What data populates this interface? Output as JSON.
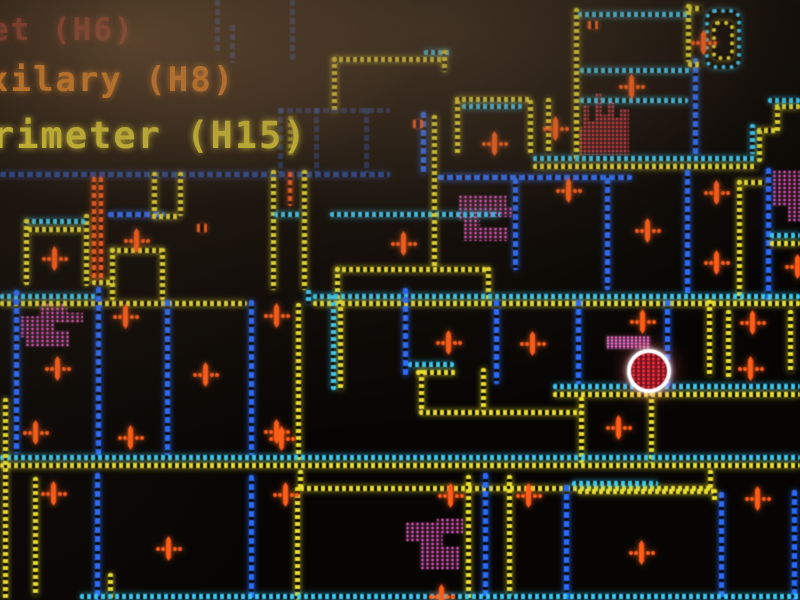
{
  "legend": {
    "items": [
      {
        "label": "et (H6)",
        "color": "#8f2a24"
      },
      {
        "label": "xilary (H8)",
        "color": "#e67d17"
      },
      {
        "label": "rimeter (H15)",
        "color": "#e3da2e"
      }
    ]
  },
  "map": {
    "colors": {
      "yellow": "#e9df3c",
      "cyan": "#41c9f2",
      "blue": "#2f6bf2",
      "orange": "#ff5f1f",
      "magenta": "#d95cb8",
      "red_hatch": "#cf3a4a",
      "pink_label": "#e773c9",
      "alarm_fill": "#70121c",
      "alarm_ring": "#ffffff"
    },
    "markers": [
      [
        703,
        42
      ],
      [
        631,
        86
      ],
      [
        494,
        143
      ],
      [
        555,
        128
      ],
      [
        716,
        192
      ],
      [
        716,
        262
      ],
      [
        797,
        266
      ],
      [
        54,
        258
      ],
      [
        136,
        240
      ],
      [
        403,
        243
      ],
      [
        568,
        190
      ],
      [
        647,
        230
      ],
      [
        57,
        368
      ],
      [
        125,
        316
      ],
      [
        205,
        374
      ],
      [
        276,
        315
      ],
      [
        276,
        431
      ],
      [
        448,
        342
      ],
      [
        532,
        343
      ],
      [
        642,
        321
      ],
      [
        752,
        322
      ],
      [
        750,
        368
      ],
      [
        618,
        427
      ],
      [
        35,
        432
      ],
      [
        130,
        437
      ],
      [
        281,
        438
      ],
      [
        53,
        493
      ],
      [
        168,
        548
      ],
      [
        285,
        494
      ],
      [
        450,
        495
      ],
      [
        528,
        495
      ],
      [
        641,
        552
      ],
      [
        757,
        498
      ],
      [
        441,
        596
      ]
    ],
    "dash_glyphs": [
      [
        202,
        228
      ],
      [
        593,
        25
      ],
      [
        418,
        124
      ]
    ],
    "hatches": [
      {
        "x": 20,
        "y": 303,
        "w": 63,
        "h": 44,
        "tone": "magenta"
      },
      {
        "x": 458,
        "y": 195,
        "w": 55,
        "h": 46,
        "tone": "magenta"
      },
      {
        "x": 772,
        "y": 170,
        "w": 28,
        "h": 52,
        "tone": "magenta"
      },
      {
        "x": 579,
        "y": 93,
        "w": 50,
        "h": 62,
        "tone": "red"
      },
      {
        "x": 405,
        "y": 518,
        "w": 58,
        "h": 52,
        "tone": "magenta"
      },
      {
        "x": 606,
        "y": 336,
        "w": 45,
        "h": 13,
        "tone": "pink"
      }
    ],
    "alarm": {
      "x": 649,
      "y": 371,
      "r": 18
    }
  }
}
